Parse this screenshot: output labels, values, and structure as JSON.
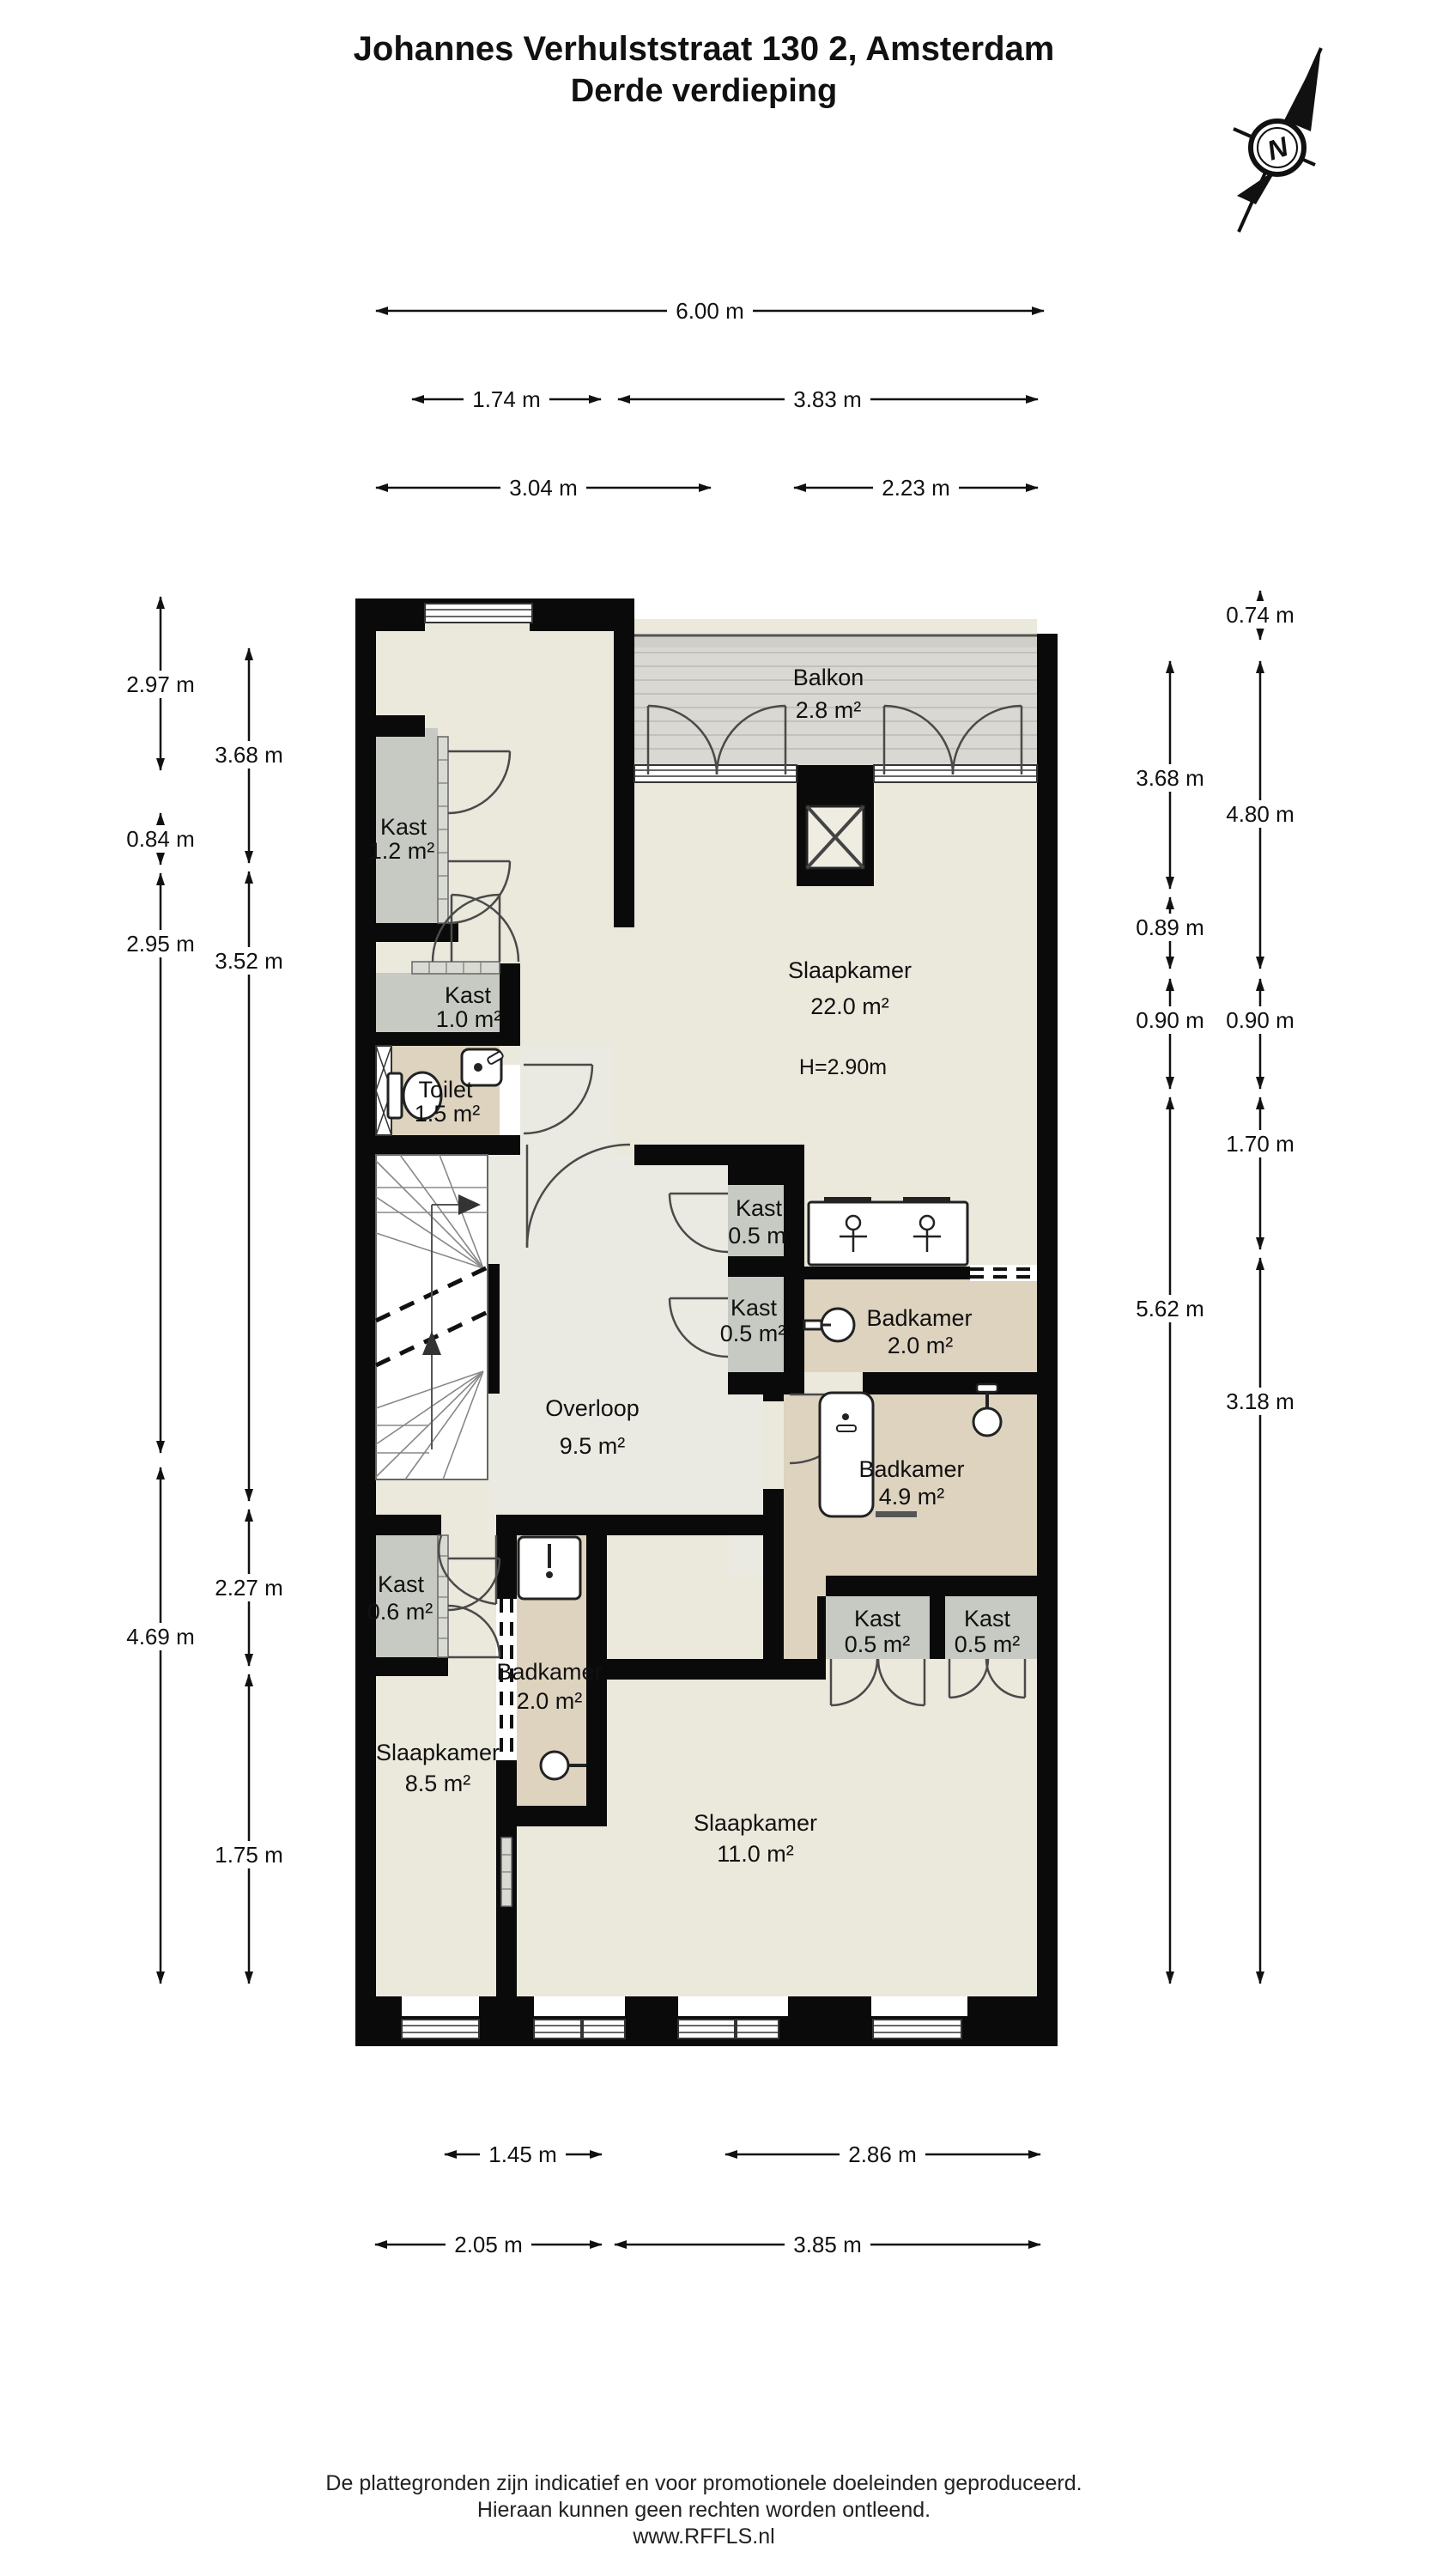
{
  "title": {
    "line1": "Johannes Verhulststraat 130 2, Amsterdam",
    "line2": "Derde verdieping"
  },
  "compass": {
    "label": "N"
  },
  "rooms": {
    "balkon": {
      "name": "Balkon",
      "area": "2.8 m²"
    },
    "kast12": {
      "name": "Kast",
      "area": "1.2 m²"
    },
    "slaapkamer22": {
      "name": "Slaapkamer",
      "area": "22.0 m²",
      "height": "H=2.90m"
    },
    "kast10": {
      "name": "Kast",
      "area": "1.0 m²"
    },
    "toilet": {
      "name": "Toilet",
      "area": "1.5 m²"
    },
    "kast05_upper": {
      "name": "Kast",
      "area": "0.5 m"
    },
    "kast05_lower": {
      "name": "Kast",
      "area": "0.5 m²"
    },
    "overloop": {
      "name": "Overloop",
      "area": "9.5 m²"
    },
    "badkamer20_boven": {
      "name": "Badkamer",
      "area": "2.0 m²"
    },
    "badkamer49": {
      "name": "Badkamer",
      "area": "4.9 m²"
    },
    "kast06": {
      "name": "Kast",
      "area": "0.6 m²"
    },
    "badkamer20_onder": {
      "name": "Badkamer",
      "area": "2.0 m²"
    },
    "slaapkamer85": {
      "name": "Slaapkamer",
      "area": "8.5 m²"
    },
    "kast05_c": {
      "name": "Kast",
      "area": "0.5 m²"
    },
    "kast05_d": {
      "name": "Kast",
      "area": "0.5 m²"
    },
    "slaapkamer11": {
      "name": "Slaapkamer",
      "area": "11.0 m²"
    }
  },
  "dimensions": {
    "top": [
      "6.00 m",
      "1.74 m",
      "3.83 m",
      "3.04 m",
      "2.23 m"
    ],
    "bottom": [
      "1.45 m",
      "2.86 m",
      "2.05 m",
      "3.85 m"
    ],
    "left_outer": [
      "2.97 m",
      "0.84 m",
      "2.95 m",
      "4.69 m"
    ],
    "left_inner": [
      "3.68 m",
      "3.52 m",
      "2.27 m",
      "1.75 m"
    ],
    "right_inner": [
      "3.68 m",
      "0.89 m",
      "0.90 m",
      "5.62 m"
    ],
    "right_outer": [
      "0.74 m",
      "4.80 m",
      "0.90 m",
      "1.70 m",
      "3.18 m"
    ]
  },
  "footer": {
    "line1": "De plattegronden zijn indicatief en voor promotionele doeleinden geproduceerd.",
    "line2": "Hieraan kunnen geen rechten worden ontleend.",
    "line3": "www.RFFLS.nl"
  },
  "colors": {
    "wall": "#0a0a0a",
    "floor": "#ebe8dc",
    "hall": "#eaeae2",
    "closet": "#c7cac2",
    "bath": "#ddd3bf",
    "balcony": "#d9d8d3"
  }
}
